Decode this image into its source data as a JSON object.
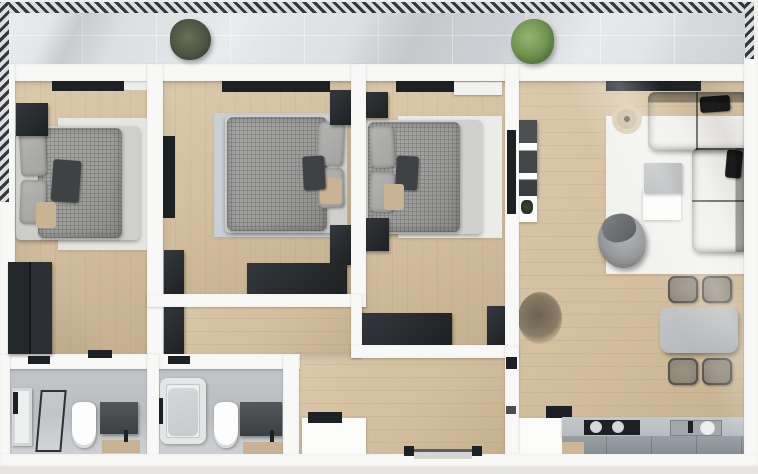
{
  "scene": {
    "kind": "3d-floor-plan-render",
    "visible_text": "",
    "rooms": {
      "balcony": {
        "items": [
          "railing",
          "potted-plant-dark",
          "potted-plant-green",
          "tiled-floor"
        ]
      },
      "bedroom_1": {
        "items": [
          "double-bed",
          "pillows",
          "area-rug",
          "nightstand",
          "wardrobe",
          "window-strip",
          "door-threshold"
        ]
      },
      "bedroom_2": {
        "items": [
          "double-bed",
          "pillows",
          "area-rug",
          "tv-panel",
          "corner-cabinet",
          "nightstand-top",
          "nightstand-bottom",
          "dresser",
          "window-strip"
        ]
      },
      "bedroom_3": {
        "items": [
          "double-bed",
          "pillows",
          "area-rug",
          "nightstand-top",
          "nightstand-bottom",
          "dresser",
          "corner-unit",
          "wall-shelf",
          "window-strip",
          "tv-panel"
        ]
      },
      "living_room": {
        "items": [
          "corner-sofa",
          "armchair",
          "side-table",
          "area-rug",
          "wall-shelf",
          "round-floor-decor",
          "dry-plant",
          "dining-table",
          "dining-chair-1",
          "dining-chair-2",
          "dining-chair-3",
          "dining-chair-4",
          "window-strip"
        ]
      },
      "kitchen": {
        "items": [
          "white-cabinet",
          "counter",
          "stove-with-pots",
          "sink",
          "dark-counter-item",
          "base-cabinet"
        ]
      },
      "hallway": {
        "items": [
          "tall-cabinet",
          "shoe-cabinet",
          "entry-door",
          "door-thresholds"
        ]
      },
      "bathroom_1": {
        "items": [
          "shower-tray",
          "glass-screen",
          "toilet",
          "vanity",
          "wood-shelf"
        ]
      },
      "bathroom_2": {
        "items": [
          "bathtub",
          "shower-fixtures",
          "toilet",
          "vanity",
          "wood-shelf"
        ]
      }
    }
  },
  "palette": {
    "outside": "#f0efed",
    "outside-bottom": "#e6e5e2",
    "wall": "#f8f8f7",
    "wood": "#d2bd9d",
    "wood-hi": "#dcc9aa",
    "wood-lo": "#c3ae8d",
    "tile": "#d3d6d9",
    "railing-dark": "#33363a",
    "railing-light": "#dcdddf",
    "duvet": "#9c9c9a",
    "pillow": "#a2a2a0",
    "pillow-dark": "#3f4245",
    "tan": "#c9b392",
    "rug1": "#e7e5e0",
    "rug2": "#c9d0d5",
    "rug3": "#ebebe9",
    "rug-living": "#f1f1ef",
    "dark": "#2a2d30",
    "darker": "#1e2124",
    "sofa": "#26282c",
    "armchair": "#97999b",
    "table-top": "#b6b9bb",
    "chair-seat": "#8e8779",
    "counter": "#b7bcbf",
    "counter-front": "#99a0a5",
    "bath-wall": "#c2c6c8",
    "bath-floor": "#d0d3d5",
    "plant-dark": "#4c5443",
    "plant-green": "#6f9350",
    "plant-dry": "#6b6257"
  }
}
